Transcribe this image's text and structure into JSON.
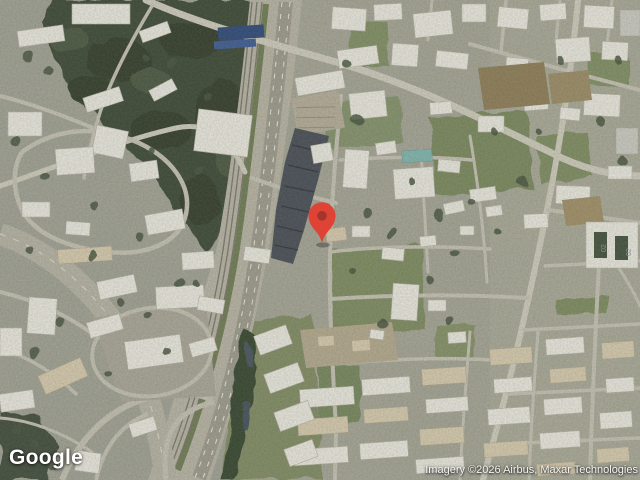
{
  "footer": {
    "logo": "Google",
    "attribution": "Imagery ©2026 Airbus, Maxar Technologies"
  },
  "map": {
    "kind": "satellite",
    "marker": {
      "color": "#DE4335",
      "inner_color": "#A5342C"
    },
    "roof_marking": "02"
  }
}
